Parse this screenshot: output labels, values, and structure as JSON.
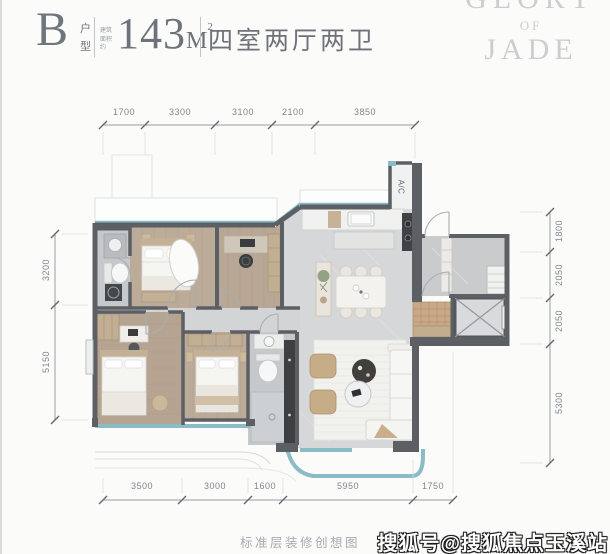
{
  "header": {
    "unit_letter": "B",
    "unit_type_label": "户型",
    "area_prefix": "建筑面积约",
    "area_value": "143",
    "area_unit": "M",
    "area_superscript": "2",
    "rooms_label": "四室两厅两卫"
  },
  "logo": {
    "line1": "GLORY",
    "line2": "OF",
    "line3": "JADE"
  },
  "dimensions": {
    "top": [
      "1700",
      "3300",
      "3100",
      "2100",
      "3850"
    ],
    "bottom": [
      "3500",
      "3000",
      "1600",
      "5950",
      "1750"
    ],
    "left": [
      "3200",
      "5150"
    ],
    "right": [
      "1800",
      "2050",
      "2050",
      "5300"
    ]
  },
  "plan": {
    "ac_label": "A/C"
  },
  "footer": {
    "caption": "标准层装修创想图",
    "watermark": "搜狐号@搜狐焦点玉溪站"
  },
  "colors": {
    "glass": "#89bcc5",
    "wall": "#5c6065",
    "wood_floor": "#bcab98",
    "tile_floor": "#c6c9cb",
    "marble_floor": "#d5d7d8",
    "accent_wood": "#c2ae93"
  }
}
